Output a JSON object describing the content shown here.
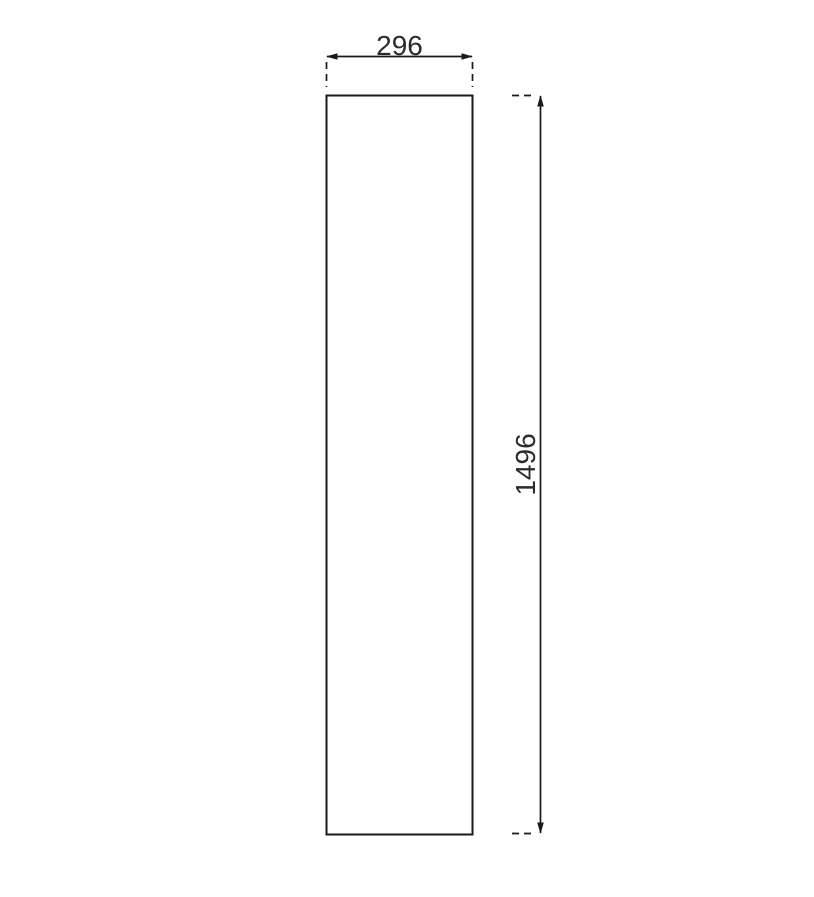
{
  "drawing": {
    "type": "technical-dimension-drawing",
    "background_color": "#ffffff",
    "line_color": "#1a1a1a",
    "text_color": "#2b2b2b",
    "part": {
      "shape": "rectangle",
      "fill": "#ffffff"
    },
    "dimensions": {
      "width": {
        "label": "296",
        "value": 296,
        "orientation": "horizontal",
        "position": "top"
      },
      "height": {
        "label": "1496",
        "value": 1496,
        "orientation": "vertical",
        "position": "right"
      }
    }
  }
}
